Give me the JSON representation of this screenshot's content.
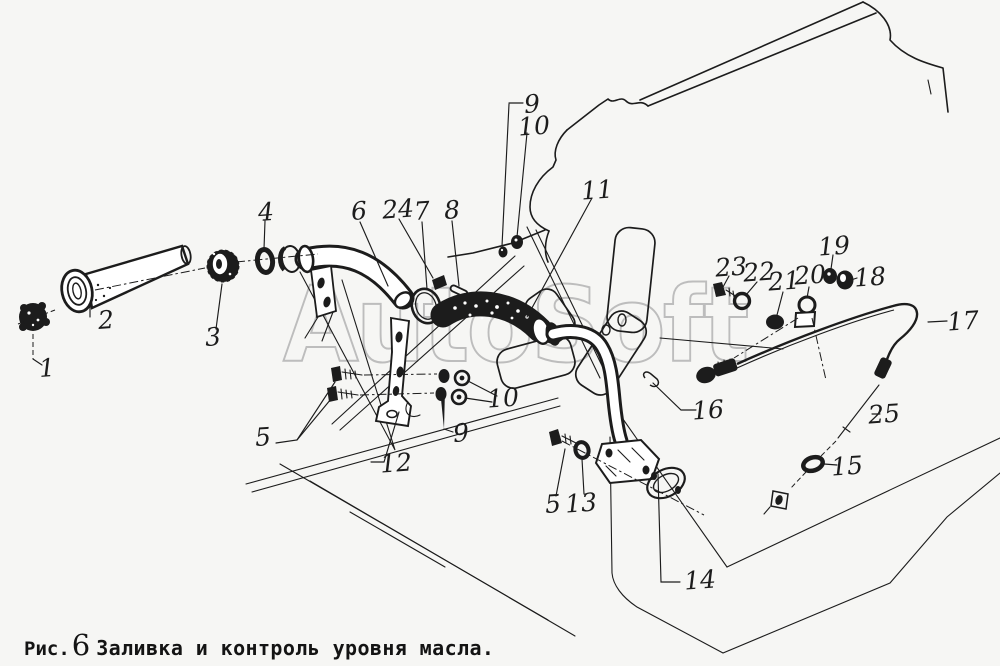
{
  "figure": {
    "type": "parts-diagram",
    "watermark": "AutoSoft",
    "caption": {
      "prefix": "Рис.",
      "number": "6",
      "title": "Заливка и контроль уровня масла."
    },
    "colors": {
      "paper": "#f6f6f4",
      "ink": "#1c1c1c",
      "watermark": "#bdbdbd"
    },
    "callouts": [
      {
        "label": "1",
        "x": 47,
        "y": 368
      },
      {
        "label": "2",
        "x": 106,
        "y": 320
      },
      {
        "label": "3",
        "x": 213,
        "y": 337
      },
      {
        "label": "4",
        "x": 266,
        "y": 212
      },
      {
        "label": "5",
        "x": 263,
        "y": 437
      },
      {
        "label": "6",
        "x": 359,
        "y": 211
      },
      {
        "label": "24",
        "x": 398,
        "y": 209
      },
      {
        "label": "7",
        "x": 422,
        "y": 211
      },
      {
        "label": "8",
        "x": 452,
        "y": 210
      },
      {
        "label": "9",
        "x": 532,
        "y": 104
      },
      {
        "label": "10",
        "x": 534,
        "y": 126
      },
      {
        "label": "11",
        "x": 597,
        "y": 190
      },
      {
        "label": "10",
        "x": 503,
        "y": 398
      },
      {
        "label": "9",
        "x": 461,
        "y": 433
      },
      {
        "label": "12",
        "x": 396,
        "y": 463
      },
      {
        "label": "5",
        "x": 553,
        "y": 504
      },
      {
        "label": "13",
        "x": 581,
        "y": 503
      },
      {
        "label": "14",
        "x": 700,
        "y": 580
      },
      {
        "label": "15",
        "x": 847,
        "y": 466
      },
      {
        "label": "16",
        "x": 708,
        "y": 410
      },
      {
        "label": "17",
        "x": 963,
        "y": 321
      },
      {
        "label": "18",
        "x": 870,
        "y": 277
      },
      {
        "label": "19",
        "x": 834,
        "y": 246
      },
      {
        "label": "20",
        "x": 810,
        "y": 275
      },
      {
        "label": "21",
        "x": 784,
        "y": 281
      },
      {
        "label": "22",
        "x": 759,
        "y": 272
      },
      {
        "label": "23",
        "x": 731,
        "y": 267
      },
      {
        "label": "25",
        "x": 884,
        "y": 414
      }
    ]
  }
}
